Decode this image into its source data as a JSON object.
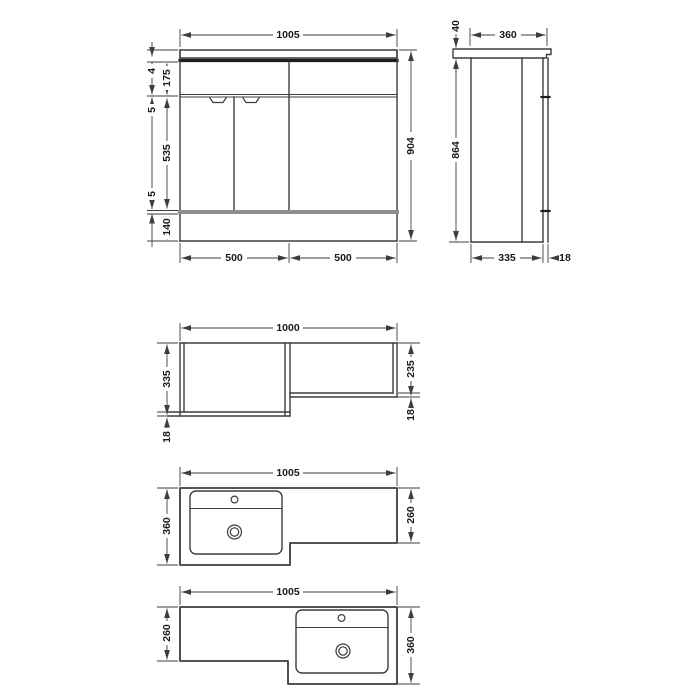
{
  "drawing": {
    "background": "#ffffff",
    "colors": {
      "line": "#3d3d3d",
      "dark": "#1e1e1e",
      "plinth_gap": "#8f8f8f",
      "text": "#1a1a1a"
    },
    "front_elevation": {
      "overall_width": "1005",
      "overall_height": "904",
      "worktop_gap": "4",
      "drawer_front_height": "175",
      "gap_upper": "5",
      "door_height": "535",
      "gap_lower": "5",
      "plinth_height": "140",
      "left_unit_width": "500",
      "right_unit_width": "500"
    },
    "side_elevation": {
      "worktop_thickness": "40",
      "worktop_depth": "360",
      "cabinet_height": "864",
      "cabinet_depth": "335",
      "door_thickness": "18"
    },
    "carcass_plan": {
      "overall_width": "1000",
      "left_depth": "335",
      "right_depth": "235",
      "left_panel_thickness": "18",
      "right_panel_thickness": "18"
    },
    "worktop_plan_left_hand": {
      "overall_width": "1005",
      "basin_side_depth": "360",
      "cistern_side_depth": "260"
    },
    "worktop_plan_right_hand": {
      "overall_width": "1005",
      "cistern_side_depth": "260",
      "basin_side_depth": "360"
    }
  }
}
